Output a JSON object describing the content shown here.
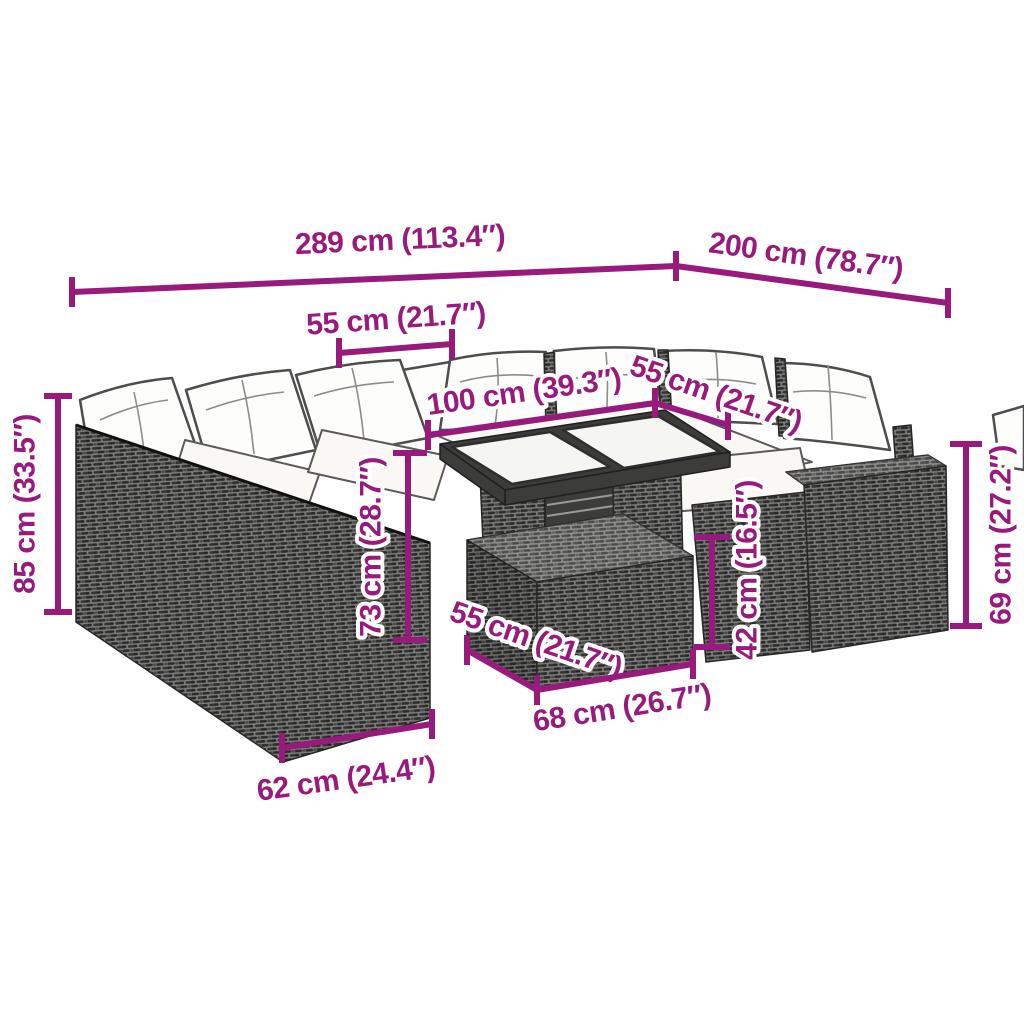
{
  "accent_color": "#981A7D",
  "diagram": {
    "kind": "furniture-dimension-diagram",
    "dims": {
      "overall_width": "289 cm (113.4″)",
      "overall_depth": "200 cm (78.7″)",
      "left_seat_width": "55 cm (21.7″)",
      "table_length": "100 cm (39.3″)",
      "table_depth": "55 cm (21.7″)",
      "sofa_height": "85 cm (33.5″)",
      "table_height": "73 cm (28.7″)",
      "ottoman_height": "42 cm (16.5″)",
      "armrest_height": "69 cm (27.2″)",
      "ottoman_width": "55 cm (21.7″)",
      "ottoman_length": "68 cm (26.7″)",
      "module_width": "62 cm (24.4″)"
    }
  }
}
